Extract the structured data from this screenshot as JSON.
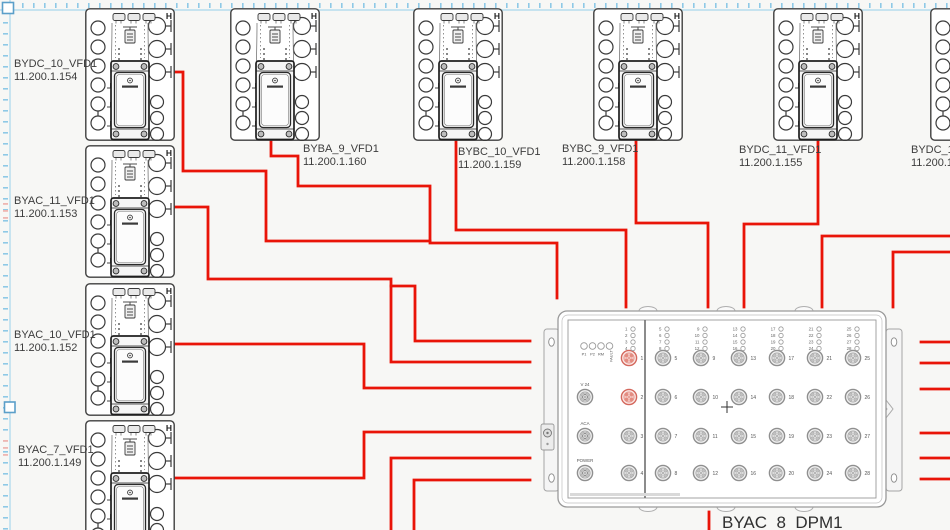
{
  "page": {
    "background": "#f7f7f5",
    "wire_color": "#e91408",
    "selection_color": "#8ec9e6",
    "selection_line_color": "#a9d7ec",
    "handle_border_color": "#5b9fc9",
    "pink_tick_color": "#efb6b2"
  },
  "devices": [
    {
      "name": "BYDC_10_VFD1",
      "ip": "11.200.1.154",
      "x": 85,
      "y": 8,
      "label_x": 14,
      "label_y": 58
    },
    {
      "name": "BYAC_11_VFD1",
      "ip": "11.200.1.153",
      "x": 85,
      "y": 145,
      "label_x": 14,
      "label_y": 195
    },
    {
      "name": "BYAC_10_VFD1",
      "ip": "11.200.1.152",
      "x": 85,
      "y": 283,
      "label_x": 14,
      "label_y": 329
    },
    {
      "name": "BYAC_7_VFD1",
      "ip": "11.200.1.149",
      "x": 85,
      "y": 420,
      "label_x": 18,
      "label_y": 444
    },
    {
      "name": "BYBA_9_VFD1",
      "ip": "11.200.1.160",
      "x": 230,
      "y": 8,
      "label_x": 303,
      "label_y": 143
    },
    {
      "name": "BYBC_10_VFD1",
      "ip": "11.200.1.159",
      "x": 413,
      "y": 8,
      "label_x": 458,
      "label_y": 146
    },
    {
      "name": "BYBC_9_VFD1",
      "ip": "11.200.1.158",
      "x": 593,
      "y": 8,
      "label_x": 562,
      "label_y": 143
    },
    {
      "name": "BYDC_11_VFD1",
      "ip": "11.200.1.155",
      "x": 773,
      "y": 8,
      "label_x": 739,
      "label_y": 144
    },
    {
      "name": "BYDC_12",
      "ip": "11.200.1.",
      "x": 930,
      "y": 8,
      "label_x": 911,
      "label_y": 144
    }
  ],
  "dpm": {
    "name": "BYAC_8_DPM1",
    "label_x": 722,
    "label_y": 513,
    "status_leds": [
      "P1",
      "P2",
      "RM",
      "FAULT"
    ],
    "status_x": [
      584,
      592.5,
      601,
      609.5
    ],
    "status_y": 346,
    "special_ports": [
      {
        "label": "V 24",
        "x": 585,
        "y": 397
      },
      {
        "label": "ACA",
        "x": 585,
        "y": 436
      },
      {
        "label": "POWER",
        "x": 585,
        "y": 473
      }
    ],
    "rows_y": [
      358,
      397,
      436,
      473
    ],
    "led_rows_y": [
      329,
      335.5,
      342,
      348.5
    ],
    "port_columns": [
      {
        "x": 629,
        "nums": [
          1,
          2,
          3,
          4
        ]
      },
      {
        "x": 663,
        "nums": [
          5,
          6,
          7,
          8
        ]
      },
      {
        "x": 701,
        "nums": [
          9,
          10,
          11,
          12
        ]
      },
      {
        "x": 739,
        "nums": [
          13,
          14,
          15,
          16
        ]
      },
      {
        "x": 777,
        "nums": [
          17,
          18,
          19,
          20
        ]
      },
      {
        "x": 815,
        "nums": [
          21,
          22,
          23,
          24
        ]
      },
      {
        "x": 853,
        "nums": [
          25,
          26,
          27,
          28
        ]
      }
    ],
    "highlighted_ports": [
      1,
      2
    ]
  },
  "wires": [
    {
      "name": "wire-bydc10",
      "points": [
        [
          175,
          72
        ],
        [
          183,
          72
        ],
        [
          183,
          171
        ],
        [
          266,
          171
        ],
        [
          266,
          241
        ],
        [
          430,
          241
        ]
      ]
    },
    {
      "name": "wire-byba9",
      "points": [
        [
          271,
          141
        ],
        [
          271,
          156
        ],
        [
          298,
          156
        ],
        [
          298,
          186
        ],
        [
          430,
          186
        ],
        [
          430,
          243
        ],
        [
          557,
          243
        ],
        [
          557,
          298
        ]
      ]
    },
    {
      "name": "wire-bybc10",
      "points": [
        [
          456,
          141
        ],
        [
          456,
          230
        ],
        [
          626,
          230
        ],
        [
          626,
          307
        ]
      ]
    },
    {
      "name": "wire-bybc9",
      "points": [
        [
          636,
          141
        ],
        [
          636,
          223
        ],
        [
          708,
          223
        ],
        [
          708,
          307
        ]
      ]
    },
    {
      "name": "wire-bydc11",
      "points": [
        [
          818,
          141
        ],
        [
          818,
          224
        ],
        [
          744,
          224
        ],
        [
          744,
          307
        ]
      ]
    },
    {
      "name": "wire-right-a",
      "points": [
        [
          950,
          236
        ],
        [
          822,
          236
        ],
        [
          822,
          307
        ]
      ]
    },
    {
      "name": "wire-right-b",
      "points": [
        [
          950,
          252
        ],
        [
          893,
          252
        ],
        [
          893,
          307
        ]
      ]
    },
    {
      "name": "wire-byac11",
      "points": [
        [
          175,
          207
        ],
        [
          208,
          207
        ],
        [
          208,
          279
        ],
        [
          391,
          279
        ],
        [
          391,
          362
        ],
        [
          530,
          362
        ]
      ]
    },
    {
      "name": "wire-byac11-br",
      "points": [
        [
          391,
          286
        ],
        [
          415,
          286
        ],
        [
          415,
          341
        ],
        [
          530,
          341
        ]
      ]
    },
    {
      "name": "wire-byac10",
      "points": [
        [
          175,
          344
        ],
        [
          364,
          344
        ],
        [
          364,
          388
        ],
        [
          530,
          388
        ]
      ]
    },
    {
      "name": "wire-byac7",
      "points": [
        [
          175,
          478
        ],
        [
          364,
          478
        ],
        [
          364,
          432
        ],
        [
          530,
          432
        ]
      ]
    },
    {
      "name": "wire-bottom-a",
      "points": [
        [
          391,
          530
        ],
        [
          391,
          458
        ],
        [
          530,
          458
        ]
      ]
    },
    {
      "name": "wire-bottom-b",
      "points": [
        [
          414,
          530
        ],
        [
          414,
          480
        ],
        [
          530,
          480
        ]
      ]
    },
    {
      "name": "wire-stub-r1",
      "points": [
        [
          921,
          342
        ],
        [
          950,
          342
        ]
      ]
    },
    {
      "name": "wire-stub-r2",
      "points": [
        [
          921,
          363
        ],
        [
          950,
          363
        ]
      ]
    },
    {
      "name": "wire-stub-r3",
      "points": [
        [
          921,
          389
        ],
        [
          950,
          389
        ]
      ]
    },
    {
      "name": "wire-stub-r4",
      "points": [
        [
          921,
          433
        ],
        [
          950,
          433
        ]
      ]
    },
    {
      "name": "wire-stub-r5",
      "points": [
        [
          921,
          458
        ],
        [
          950,
          458
        ]
      ]
    },
    {
      "name": "wire-stub-r6",
      "points": [
        [
          921,
          479
        ],
        [
          950,
          479
        ]
      ]
    },
    {
      "name": "wire-dpm-stub",
      "points": [
        [
          709,
          512
        ],
        [
          709,
          530
        ]
      ]
    }
  ]
}
